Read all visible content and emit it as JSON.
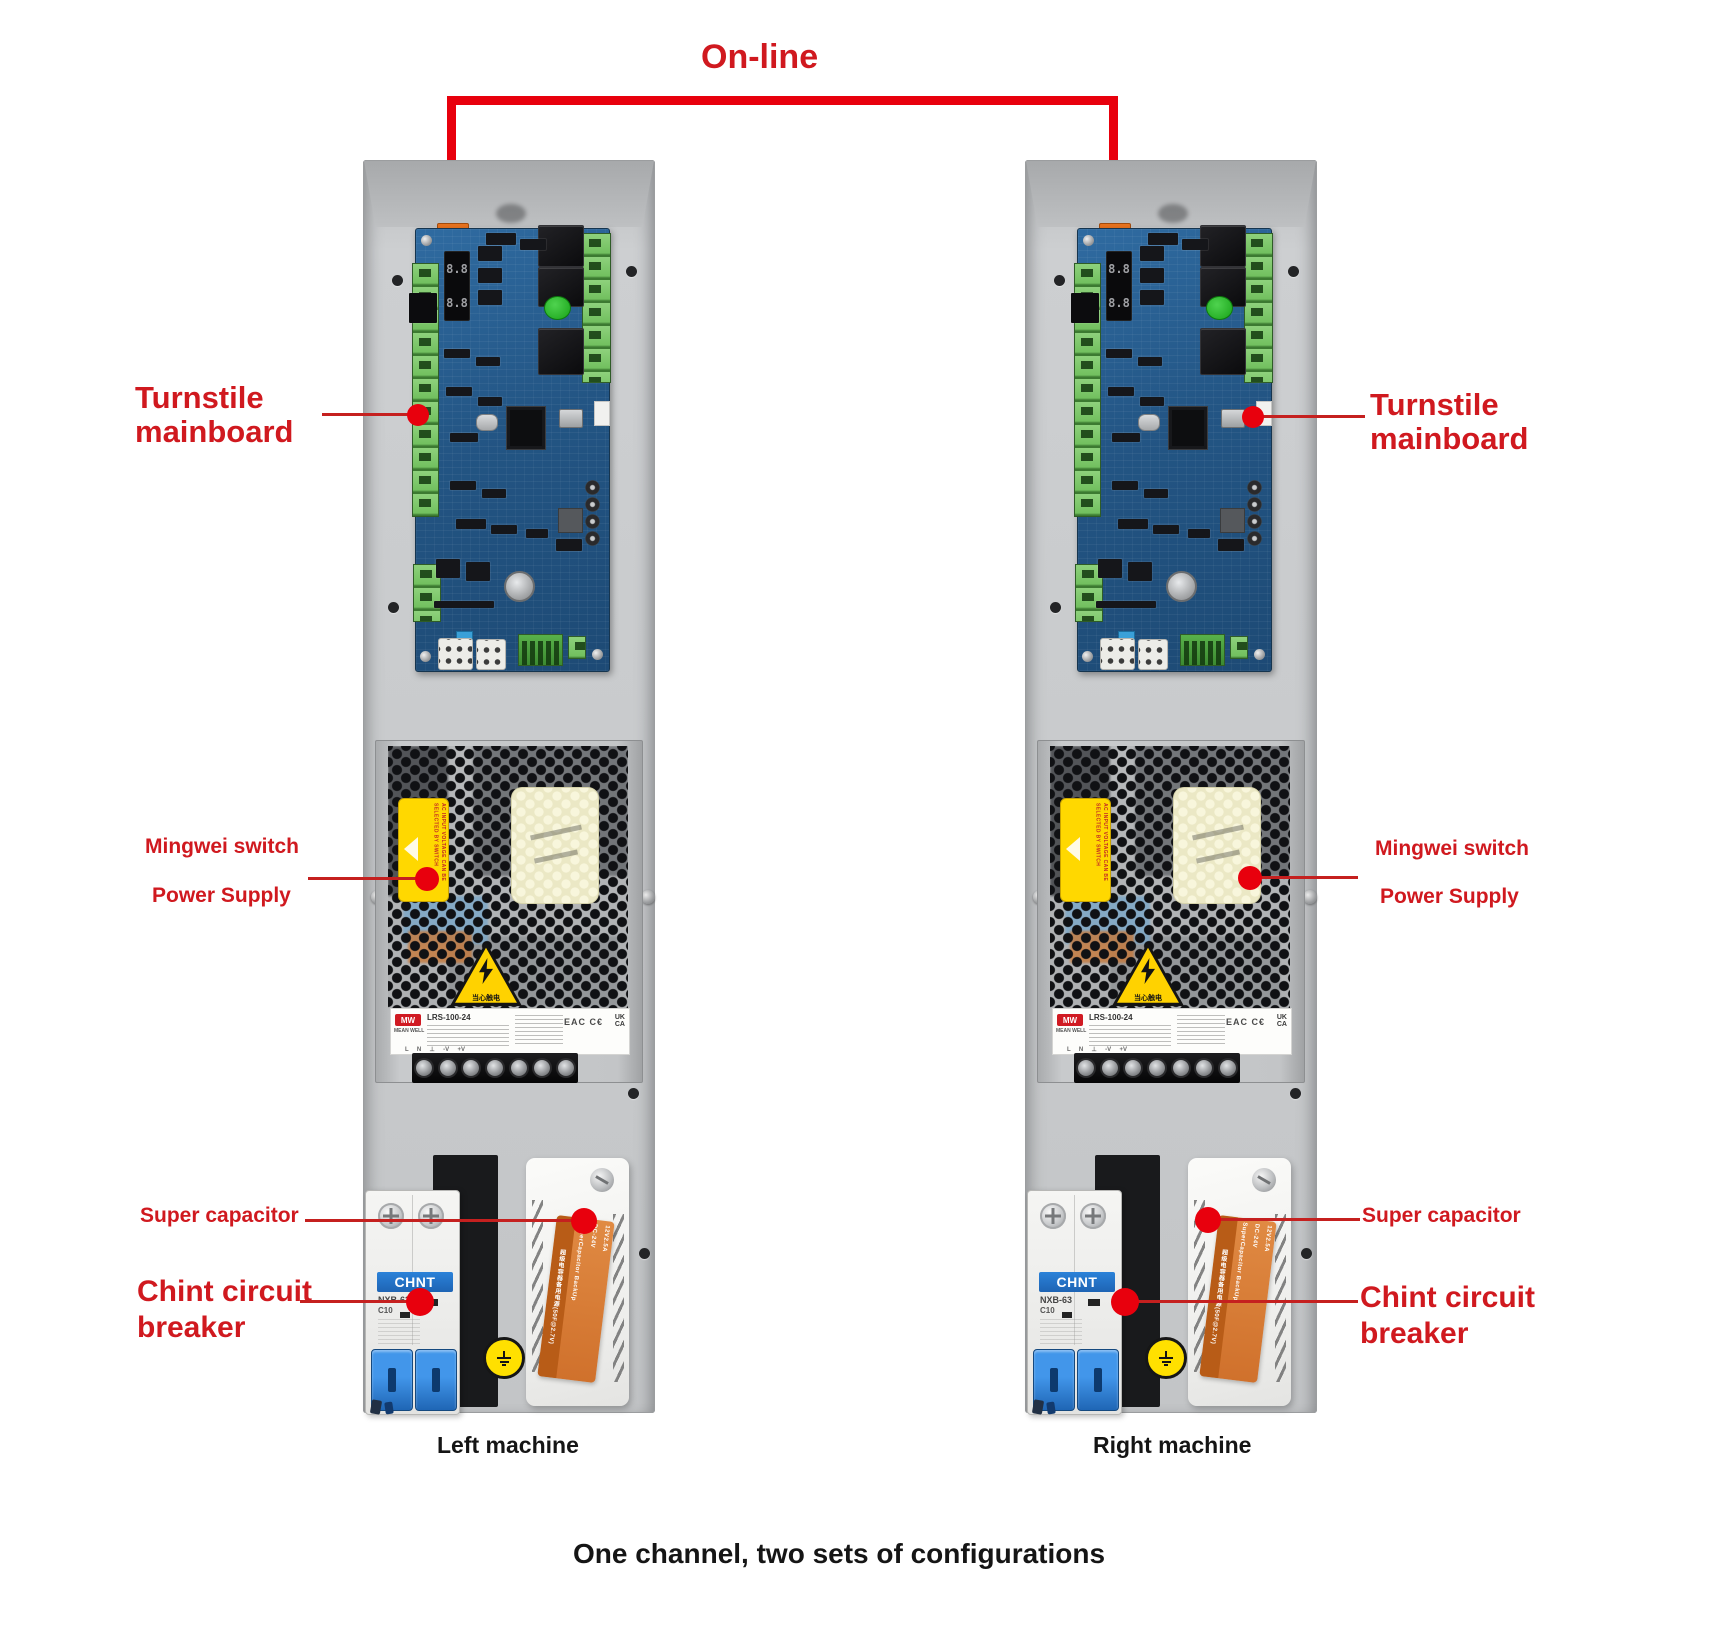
{
  "title": "On-line",
  "annotations": {
    "turnstile_line1": "Turnstile",
    "turnstile_line2": "mainboard",
    "mingwei_line1": "Mingwei switch",
    "mingwei_line2": "Power Supply",
    "supercap": "Super capacitor",
    "chint_line1": "Chint circuit",
    "chint_line2": "breaker"
  },
  "captions": {
    "left": "Left machine",
    "right": "Right machine"
  },
  "footer": "One channel, two sets of configurations",
  "device_text": {
    "seg_display": "8.8",
    "psu_logo": "MW",
    "psu_brand": "MEAN WELL",
    "psu_model": "LRS-100-24",
    "psu_cert": "EAC C€",
    "psu_cert_uk": "UK",
    "psu_cert_ca": "CA",
    "psu_warning_cn": "当心触电",
    "psu_yellow_note": "AC INPUT VOLTAGE CAN BE SELECTED BY SWITCH",
    "psu_terminals": "L     N     ⊥     -V     +V",
    "breaker_brand": "CHNT",
    "breaker_model": "NXB-63",
    "breaker_rating": "C10",
    "supercap_title_cn": "超级电容器备用电源(50F@2.7V)",
    "supercap_title_en": "SuperCapacitor BackUp",
    "supercap_spec1": "DC-24V",
    "supercap_spec2": "12V2.5A"
  },
  "colors": {
    "bracket_red": "#e8000d",
    "label_red": "#d0191f",
    "panel_gray": "#c7c9cb",
    "pcb_blue": "#275b8d",
    "psu_yellow": "#ffd800",
    "breaker_blue": "#2272c8",
    "supercap_orange": "#d0712c"
  }
}
